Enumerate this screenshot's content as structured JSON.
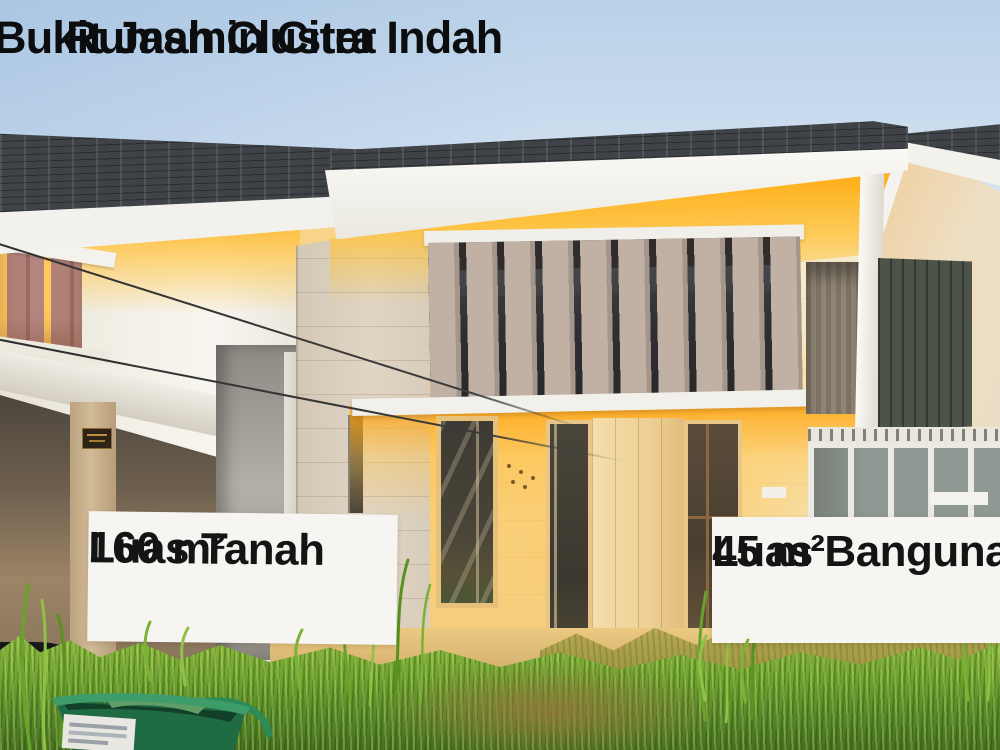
{
  "header": {
    "title_line1": "Rumah Cluster",
    "title_line2": "Bukit Jasmin Citra Indah"
  },
  "badges": {
    "land": {
      "label": "Luas Tanah",
      "value": "160 m²"
    },
    "building": {
      "label": "Luas Bangunan",
      "value": "45 m²"
    }
  },
  "palette": {
    "sky_top": "#b9d1e8",
    "sky_bottom": "#eef2f5",
    "roof_dark": "#3f4347",
    "fascia_white": "#f2f1ed",
    "glow_yellow": "#ffb01c",
    "wall_cream": "#f6e9c6",
    "stone_wall": "#d8ccba",
    "louver_fin_taupe": "#c1b0a4",
    "left_louver_mauve": "#b18178",
    "olive_panel": "#4e5349",
    "door_frame_gold": "#e9c687",
    "grass_green": "#6fa42e",
    "grass_yellow": "#c8ae5e",
    "dirt_brown": "#967636",
    "bucket_green": "#1f6b43",
    "badge_background": "#f7f5f2",
    "text_black": "#0c0d0e"
  }
}
